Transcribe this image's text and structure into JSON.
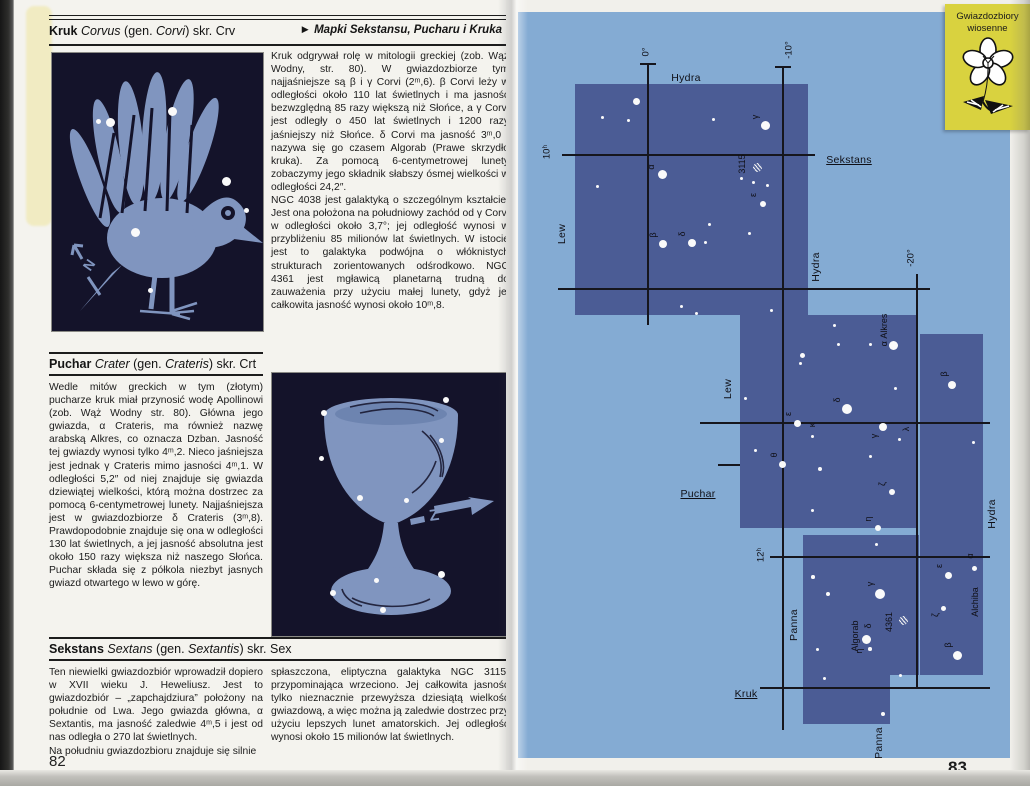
{
  "left_page": {
    "page_number": "82",
    "kruk": {
      "heading": {
        "bold": "Kruk",
        "latin": "Corvus",
        "p1": "(gen. ",
        "latin2": "Corvi",
        "p2": ") skr. Crv"
      },
      "map_ref_arrow": "►",
      "map_ref": "Mapki Sekstansu, Pucharu i Kruka",
      "paragraphs": [
        "Kruk odgrywał rolę w mitologii greckiej (zob. Wąż Wodny, str. 80). W gwiazdozbiorze tym najjaśniejsze są β i γ Corvi (2ᵐ,6). β Corvi leży w odległości około 110 lat świetlnych i ma jasność bezwzględną 85 razy większą niż Słońce, a γ Corvi jest odległy o 450 lat świetlnych i 1200 razy jaśniejszy niż Słońce. δ Corvi ma jasność 3ᵐ,0 i nazywa się go czasem Algorab (Prawe skrzydło kruka). Za pomocą 6-centymetrowej lunety zobaczymy jego składnik słabszy ósmej wielkości w odległości 24,2″.",
        "NGC 4038 jest galaktyką o szczególnym kształcie. Jest ona położona na południowy zachód od γ Corvi w odległości około 3,7°; jej odległość wynosi w przybliżeniu 85 milionów lat świetlnych. W istocie jest to galaktyka podwójna o włóknistych strukturach zorientowanych odśrodkowo. NGC 4361 jest mgławicą planetarną trudną do zauważenia przy użyciu małej lunety, gdyż jej całkowita jasność wynosi około 10ᵐ,8."
      ],
      "illustration": {
        "subject": "kruk (crow) constellation figure",
        "arrow_label": "N",
        "stars": [
          {
            "x": 46,
            "y": 68,
            "r": 2.5
          },
          {
            "x": 58,
            "y": 69,
            "r": 4.5
          },
          {
            "x": 120,
            "y": 58,
            "r": 4.5
          },
          {
            "x": 174,
            "y": 128,
            "r": 4.5
          },
          {
            "x": 194,
            "y": 157,
            "r": 2.5
          },
          {
            "x": 83,
            "y": 179,
            "r": 4.5
          },
          {
            "x": 98,
            "y": 237,
            "r": 2.5
          }
        ]
      }
    },
    "puchar": {
      "heading": {
        "bold": "Puchar",
        "latin": "Crater",
        "p1": "(gen. ",
        "latin2": "Crateris",
        "p2": ") skr. Crt"
      },
      "paragraphs": [
        "Wedle mitów greckich w tym (złotym) pucharze kruk miał przynosić wodę Apollinowi (zob. Wąż Wodny str. 80). Główna jego gwiazda, α Crateris, ma również nazwę arabską Alkres, co oznacza Dzban. Jasność tej gwiazdy wynosi tylko 4ᵐ,2. Nieco jaśniejsza jest jednak γ Crateris mimo jasności 4ᵐ,1. W odległości 5,2″ od niej znajduje się gwiazda dziewiątej wielkości, którą można dostrzec za pomocą 6-centymetrowej lunety. Najjaśniejsza jest w gwiazdozbiorze δ Crateris (3ᵐ,8). Prawdopodobnie znajduje się ona w odległości 130 lat świetlnych, a jej jasność absolutna jest około 150 razy większa niż naszego Słońca. Puchar składa się z półkola niezbyt jasnych gwiazd otwartego w lewo w górę."
      ],
      "illustration": {
        "subject": "puchar (goblet) constellation figure",
        "arrow_label": "Z",
        "stars": [
          {
            "x": 52,
            "y": 40,
            "r": 3
          },
          {
            "x": 174,
            "y": 27,
            "r": 3
          },
          {
            "x": 169,
            "y": 67,
            "r": 2.5
          },
          {
            "x": 49,
            "y": 85,
            "r": 2.5
          },
          {
            "x": 88,
            "y": 125,
            "r": 3
          },
          {
            "x": 134,
            "y": 127,
            "r": 2.5
          },
          {
            "x": 61,
            "y": 220,
            "r": 3
          },
          {
            "x": 104,
            "y": 207,
            "r": 2.5
          },
          {
            "x": 169,
            "y": 201,
            "r": 3.5
          },
          {
            "x": 111,
            "y": 237,
            "r": 3
          }
        ]
      }
    },
    "sekstans": {
      "heading": {
        "bold": "Sekstans",
        "latin": "Sextans",
        "p1": "(gen. ",
        "latin2": "Sextantis",
        "p2": ") skr. Sex"
      },
      "col_left": [
        "Ten niewielki gwiazdozbiór wprowadził dopiero w XVII wieku J. Heweliusz. Jest to gwiazdozbiór – „zapchajdziura” położony na południe od Lwa. Jego gwiazda główna, α Sextantis, ma jasność zaledwie 4ᵐ,5 i jest od nas odległa o 270 lat świetlnych.",
        "Na południu gwiazdozbioru znajduje się silnie"
      ],
      "col_right": [
        "spłaszczona, eliptyczna galaktyka NGC 3115, przypominająca wrzeciono. Jej całkowita jasność tylko nieznacznie przewyższa dziesiątą wielkość gwiazdową, a więc można ją zaledwie dostrzec przy użyciu lepszych lunet amatorskich. Jej odległość wynosi około 15 milionów lat świetlnych."
      ]
    }
  },
  "right_page": {
    "page_number": "83",
    "tab": {
      "line1": "Gwiazdozbiory",
      "line2": "wiosenne"
    },
    "map": {
      "colors": {
        "background": "#84abd3",
        "region": "#4b5c95",
        "line": "#16161d",
        "star": "#fafafa"
      },
      "regions": [
        {
          "x": 57,
          "y": 72,
          "w": 233,
          "h": 231
        },
        {
          "x": 222,
          "y": 303,
          "w": 177,
          "h": 213
        },
        {
          "x": 402,
          "y": 322,
          "w": 63,
          "h": 341
        },
        {
          "x": 285,
          "y": 523,
          "w": 116,
          "h": 140
        },
        {
          "x": 285,
          "y": 663,
          "w": 87,
          "h": 49
        }
      ],
      "light_patches": [
        {
          "x": 285,
          "y": 516,
          "w": 116,
          "h": 7
        }
      ],
      "lines": [
        {
          "o": "v",
          "x": 130,
          "y": 52,
          "len": 261
        },
        {
          "o": "v",
          "x": 265,
          "y": 55,
          "len": 663
        },
        {
          "o": "v",
          "x": 399,
          "y": 262,
          "len": 414
        },
        {
          "o": "h",
          "x": 44,
          "y": 143,
          "len": 253
        },
        {
          "o": "h",
          "x": 40,
          "y": 277,
          "len": 372
        },
        {
          "o": "h",
          "x": 182,
          "y": 411,
          "len": 290
        },
        {
          "o": "h",
          "x": 252,
          "y": 545,
          "len": 220
        },
        {
          "o": "h",
          "x": 242,
          "y": 676,
          "len": 230
        },
        {
          "o": "h",
          "x": 200,
          "y": 453,
          "len": 22
        },
        {
          "o": "h",
          "x": 122,
          "y": 52,
          "len": 16
        },
        {
          "o": "h",
          "x": 257,
          "y": 55,
          "len": 16
        }
      ],
      "stars": [
        {
          "x": 118,
          "y": 89,
          "r": 3.5
        },
        {
          "x": 84,
          "y": 105,
          "r": 1.5
        },
        {
          "x": 110,
          "y": 108,
          "r": 1.5
        },
        {
          "x": 195,
          "y": 107,
          "r": 1.5
        },
        {
          "x": 247,
          "y": 113,
          "r": 4.5
        },
        {
          "x": 144,
          "y": 162,
          "r": 4.5
        },
        {
          "x": 223,
          "y": 166,
          "r": 1.5
        },
        {
          "x": 235,
          "y": 170,
          "r": 1.5
        },
        {
          "x": 79,
          "y": 174,
          "r": 1.5
        },
        {
          "x": 249,
          "y": 173,
          "r": 1.5
        },
        {
          "x": 191,
          "y": 212,
          "r": 1.5
        },
        {
          "x": 145,
          "y": 232,
          "r": 4
        },
        {
          "x": 174,
          "y": 231,
          "r": 4
        },
        {
          "x": 231,
          "y": 221,
          "r": 1.5
        },
        {
          "x": 187,
          "y": 230,
          "r": 1.5
        },
        {
          "x": 245,
          "y": 192,
          "r": 3
        },
        {
          "x": 163,
          "y": 294,
          "r": 1.5
        },
        {
          "x": 178,
          "y": 301,
          "r": 1.5
        },
        {
          "x": 253,
          "y": 298,
          "r": 1.5
        },
        {
          "x": 239,
          "y": 155,
          "r": 4.5,
          "h": 1
        },
        {
          "x": 375,
          "y": 333,
          "r": 4.5
        },
        {
          "x": 434,
          "y": 373,
          "r": 4
        },
        {
          "x": 329,
          "y": 397,
          "r": 5
        },
        {
          "x": 279,
          "y": 411,
          "r": 3.5
        },
        {
          "x": 294,
          "y": 424,
          "r": 1.5
        },
        {
          "x": 365,
          "y": 415,
          "r": 4
        },
        {
          "x": 381,
          "y": 427,
          "r": 1.5
        },
        {
          "x": 264,
          "y": 452,
          "r": 3.5
        },
        {
          "x": 374,
          "y": 480,
          "r": 3
        },
        {
          "x": 360,
          "y": 516,
          "r": 3
        },
        {
          "x": 284,
          "y": 343,
          "r": 2.5
        },
        {
          "x": 282,
          "y": 351,
          "r": 1.5
        },
        {
          "x": 316,
          "y": 313,
          "r": 1.5
        },
        {
          "x": 320,
          "y": 332,
          "r": 1.5
        },
        {
          "x": 352,
          "y": 332,
          "r": 1.5
        },
        {
          "x": 377,
          "y": 376,
          "r": 1.5
        },
        {
          "x": 227,
          "y": 386,
          "r": 1.5
        },
        {
          "x": 237,
          "y": 438,
          "r": 1.5
        },
        {
          "x": 302,
          "y": 457,
          "r": 2
        },
        {
          "x": 294,
          "y": 498,
          "r": 1.5
        },
        {
          "x": 352,
          "y": 444,
          "r": 1.5
        },
        {
          "x": 455,
          "y": 430,
          "r": 1.5
        },
        {
          "x": 358,
          "y": 532,
          "r": 1.5
        },
        {
          "x": 362,
          "y": 582,
          "r": 5
        },
        {
          "x": 348,
          "y": 627,
          "r": 4.5
        },
        {
          "x": 352,
          "y": 637,
          "r": 1.8
        },
        {
          "x": 385,
          "y": 608,
          "r": 4.5,
          "h": 1
        },
        {
          "x": 425,
          "y": 596,
          "r": 2.5
        },
        {
          "x": 439,
          "y": 643,
          "r": 4.5
        },
        {
          "x": 430,
          "y": 563,
          "r": 3.5
        },
        {
          "x": 456,
          "y": 556,
          "r": 2.5
        },
        {
          "x": 295,
          "y": 565,
          "r": 1.8
        },
        {
          "x": 310,
          "y": 582,
          "r": 2.2
        },
        {
          "x": 299,
          "y": 637,
          "r": 1.5
        },
        {
          "x": 382,
          "y": 663,
          "r": 1.5
        },
        {
          "x": 365,
          "y": 702,
          "r": 2
        },
        {
          "x": 306,
          "y": 666,
          "r": 1.5
        }
      ],
      "labels": [
        {
          "t": "0°",
          "x": 128,
          "y": 40,
          "rot": 1,
          "cls": "g"
        },
        {
          "t": "-10°",
          "x": 271,
          "y": 38,
          "rot": 1,
          "cls": "g"
        },
        {
          "t": "-20°",
          "x": 393,
          "y": 246,
          "rot": 1,
          "cls": "g"
        },
        {
          "t": "10ʰ",
          "x": 29,
          "y": 140,
          "rot": 1,
          "cls": "g"
        },
        {
          "t": "12ʰ",
          "x": 243,
          "y": 543,
          "rot": 1,
          "cls": "g"
        },
        {
          "t": "Hydra",
          "x": 168,
          "y": 66,
          "cls": "c"
        },
        {
          "t": "Sekstans",
          "x": 331,
          "y": 148,
          "u": 1,
          "cls": "c"
        },
        {
          "t": "Lew",
          "x": 44,
          "y": 222,
          "rot": 1,
          "cls": "c"
        },
        {
          "t": "Hydra",
          "x": 298,
          "y": 255,
          "rot": 1,
          "cls": "c"
        },
        {
          "t": "Lew",
          "x": 210,
          "y": 377,
          "rot": 1,
          "cls": "c"
        },
        {
          "t": "Puchar",
          "x": 180,
          "y": 482,
          "u": 1,
          "cls": "c"
        },
        {
          "t": "Hydra",
          "x": 474,
          "y": 502,
          "rot": 1,
          "cls": "c"
        },
        {
          "t": "Kruk",
          "x": 228,
          "y": 682,
          "u": 1,
          "cls": "c"
        },
        {
          "t": "Panna",
          "x": 276,
          "y": 613,
          "rot": 1,
          "cls": "c"
        },
        {
          "t": "Panna",
          "x": 361,
          "y": 731,
          "rot": 1,
          "cls": "c"
        },
        {
          "t": "γ",
          "x": 237,
          "y": 105,
          "rot": 1,
          "cls": "s"
        },
        {
          "t": "α",
          "x": 133,
          "y": 155,
          "rot": 1,
          "cls": "s"
        },
        {
          "t": "3115",
          "x": 224,
          "y": 152,
          "rot": 1,
          "cls": "s"
        },
        {
          "t": "ε",
          "x": 235,
          "y": 183,
          "rot": 1,
          "cls": "s"
        },
        {
          "t": "β",
          "x": 135,
          "y": 223,
          "rot": 1,
          "cls": "s"
        },
        {
          "t": "δ",
          "x": 164,
          "y": 222,
          "rot": 1,
          "cls": "s"
        },
        {
          "t": "α Alkres",
          "x": 366,
          "y": 318,
          "rot": 1,
          "cls": "s"
        },
        {
          "t": "β",
          "x": 426,
          "y": 362,
          "rot": 1,
          "cls": "s"
        },
        {
          "t": "δ",
          "x": 319,
          "y": 388,
          "rot": 1,
          "cls": "s"
        },
        {
          "t": "ε",
          "x": 270,
          "y": 402,
          "rot": 1,
          "cls": "s"
        },
        {
          "t": "κ",
          "x": 294,
          "y": 413,
          "rot": 1,
          "cls": "s"
        },
        {
          "t": "γ",
          "x": 356,
          "y": 424,
          "rot": 1,
          "cls": "s"
        },
        {
          "t": "λ",
          "x": 388,
          "y": 417,
          "rot": 1,
          "cls": "s"
        },
        {
          "t": "θ",
          "x": 256,
          "y": 443,
          "rot": 1,
          "cls": "s"
        },
        {
          "t": "ζ",
          "x": 364,
          "y": 472,
          "rot": 1,
          "cls": "s"
        },
        {
          "t": "η",
          "x": 350,
          "y": 507,
          "rot": 1,
          "cls": "s"
        },
        {
          "t": "γ",
          "x": 352,
          "y": 572,
          "rot": 1,
          "cls": "s"
        },
        {
          "t": "δ",
          "x": 350,
          "y": 614,
          "rot": 1,
          "cls": "s"
        },
        {
          "t": "Algorab",
          "x": 337,
          "y": 624,
          "rot": 1,
          "cls": "s"
        },
        {
          "t": "η",
          "x": 341,
          "y": 639,
          "rot": 1,
          "cls": "s"
        },
        {
          "t": "4361",
          "x": 371,
          "y": 610,
          "rot": 1,
          "cls": "s"
        },
        {
          "t": "ζ",
          "x": 417,
          "y": 603,
          "rot": 1,
          "cls": "s"
        },
        {
          "t": "β",
          "x": 430,
          "y": 633,
          "rot": 1,
          "cls": "s"
        },
        {
          "t": "ε",
          "x": 421,
          "y": 554,
          "rot": 1,
          "cls": "s"
        },
        {
          "t": "α",
          "x": 452,
          "y": 544,
          "rot": 1,
          "cls": "s"
        },
        {
          "t": "Alchiba",
          "x": 457,
          "y": 590,
          "rot": 1,
          "cls": "s"
        }
      ]
    }
  }
}
